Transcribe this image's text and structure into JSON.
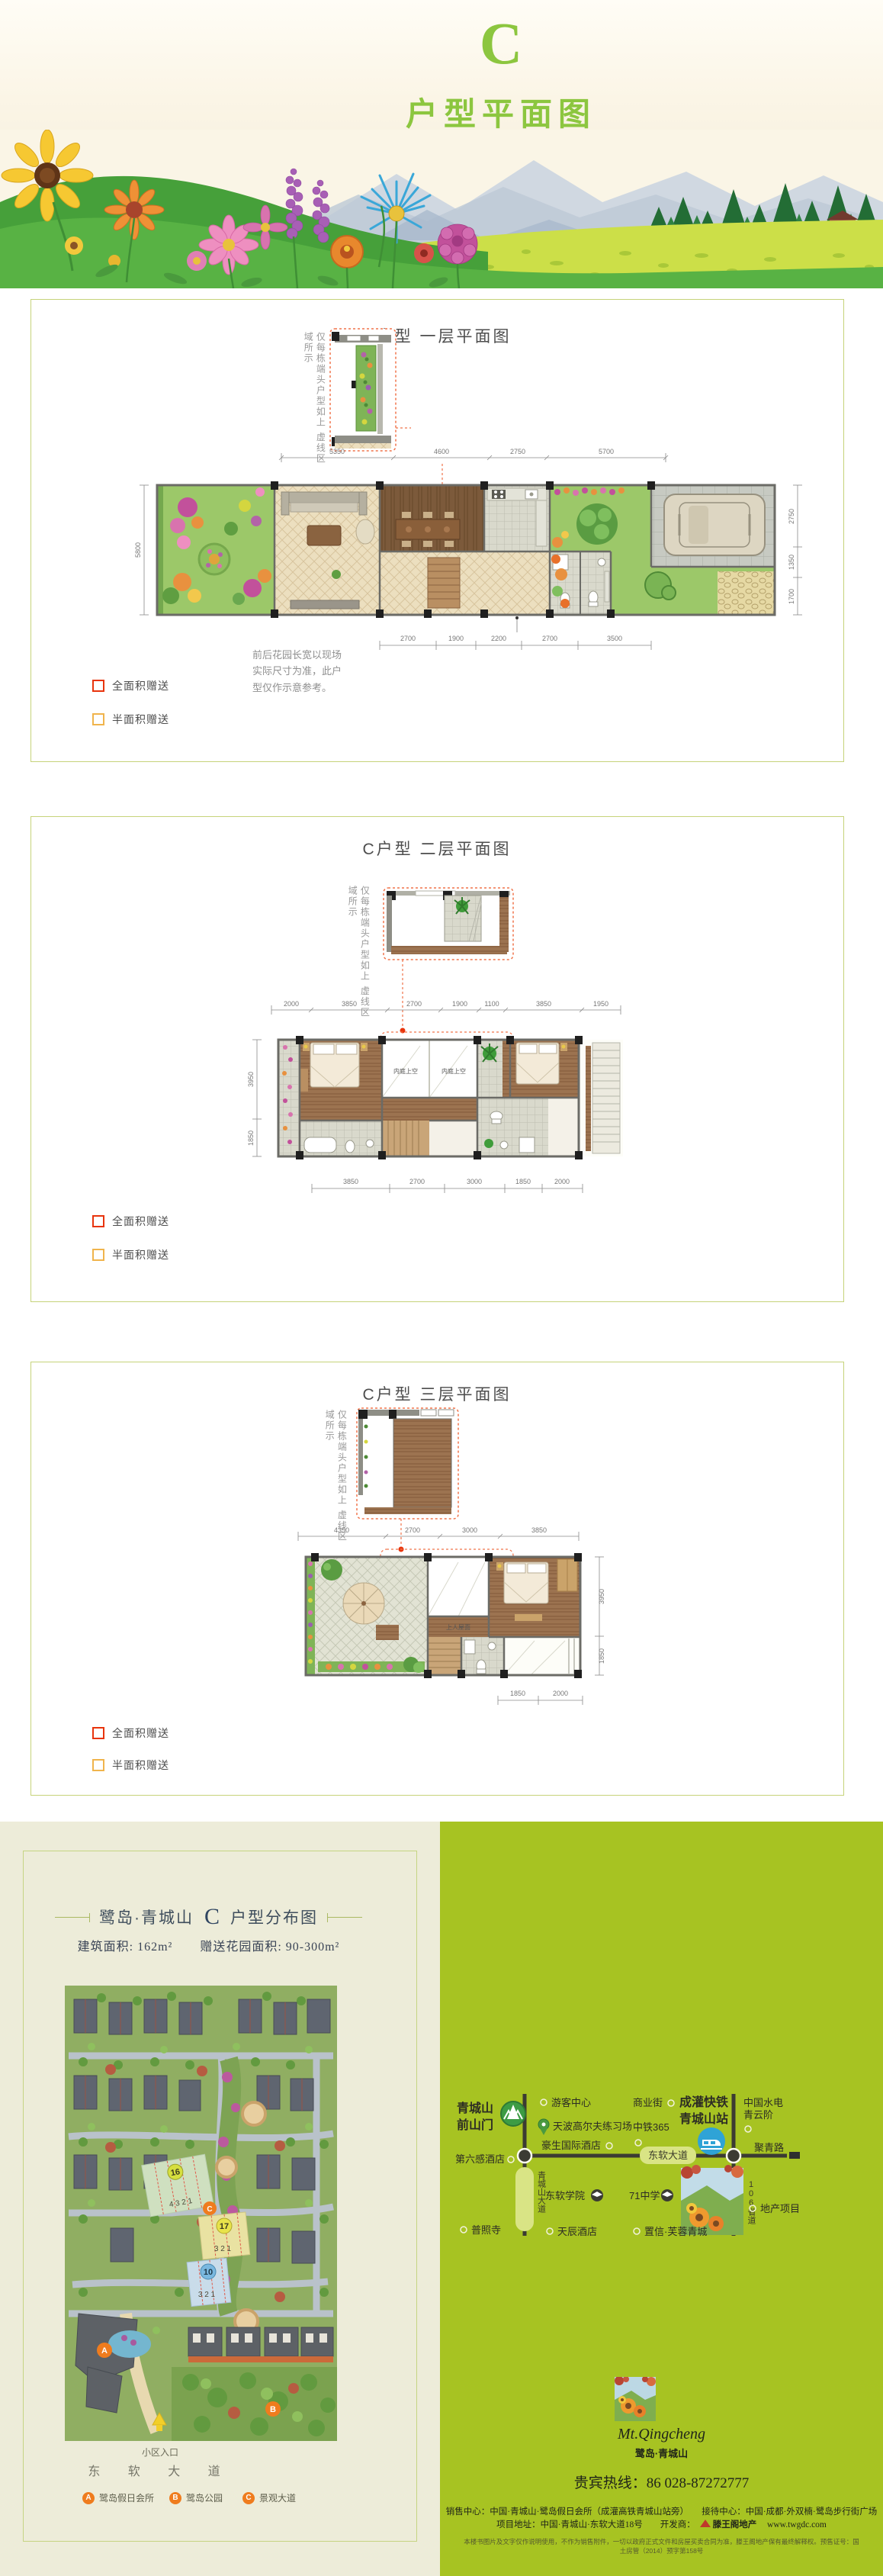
{
  "header": {
    "letter": "C",
    "title": "户型平面图"
  },
  "legend": {
    "full": "全面积赠送",
    "half": "半面积赠送"
  },
  "floor1": {
    "title": "C户型 一层平面图",
    "side_note_a": "仅每栋端头户型如上",
    "side_note_b": "虚线区域所示",
    "dims_top": [
      "5350",
      "4600",
      "2750",
      "5700"
    ],
    "dim_left": "5800",
    "dims_right": [
      "2750",
      "1350",
      "1700"
    ],
    "dims_bottom": [
      "2700",
      "1900",
      "2200",
      "2700",
      "3500"
    ],
    "note": "前后花园长宽以现场实际尺寸为准，此户型仅作示意参考。"
  },
  "floor2": {
    "title": "C户型 二层平面图",
    "side_note_a": "仅每栋端头户型如上",
    "side_note_b": "虚线区域所示",
    "dims_top": [
      "2000",
      "3850",
      "2700",
      "1900",
      "1100",
      "3850",
      "1950"
    ],
    "dims_left": [
      "3950",
      "1850"
    ],
    "dims_bottom": [
      "3850",
      "2700",
      "3000",
      "1850",
      "2000"
    ],
    "void_label_1": "内庭上空",
    "void_label_2": "内庭上空"
  },
  "floor3": {
    "title": "C户型 三层平面图",
    "side_note_a": "仅每栋端头户型如上",
    "side_note_b": "虚线区域所示",
    "dims_top": [
      "4350",
      "2700",
      "3000",
      "3850"
    ],
    "dims_right": [
      "3950",
      "1850"
    ],
    "dims_bottom": [
      "1850",
      "2000"
    ],
    "roof_label": "上人屋面"
  },
  "distribution": {
    "brand": "鹭岛·青城山",
    "letter": "C",
    "suffix": "户型分布图",
    "area_label_1": "建筑面积:",
    "area_value_1": "162m²",
    "area_label_2": "赠送花园面积:",
    "area_value_2": "90-300m²",
    "block16": "16",
    "block16_units": "4  3  2  1",
    "block17": "17",
    "block17_units": "3  2  1",
    "block10": "10",
    "block10_units": "3  2  1",
    "marker_a": "A",
    "marker_b": "B",
    "marker_c": "C",
    "entrance": "小区入口",
    "road": "东 软 大 道",
    "legend": [
      {
        "badge": "A",
        "label": "鹭岛假日会所"
      },
      {
        "badge": "B",
        "label": "鹭岛公园"
      },
      {
        "badge": "C",
        "label": "景观大道"
      }
    ]
  },
  "transit": {
    "gate1": "青城山",
    "gate2": "前山门",
    "hotel6": "第六感酒店",
    "visitor": "游客中心",
    "golf": "天波高尔夫练习场",
    "howard": "豪生国际酒店",
    "road_v1": "青城山大道",
    "road_h": "东软大道",
    "biz": "商业街",
    "zt365": "中铁365",
    "rail1": "成灌快铁",
    "rail2": "青城山站",
    "hydro1": "中国水电",
    "hydro2": "青云阶",
    "road_r": "聚青路",
    "road_v2": "106省道",
    "college": "东软学院",
    "school": "71中学",
    "estate": "地产项目",
    "temple": "普照寺",
    "tianchen": "天辰酒店",
    "zhixin": "置信·芙蓉青城"
  },
  "footer": {
    "logo_script": "Mt.Qingcheng",
    "logo_cn": "鹭岛·青城山",
    "hotline": "贵宾热线：86 028-87272777",
    "line1": "销售中心：中国·青城山·鹭岛假日会所（成灌高铁青城山站旁）　　接待中心：中国·成都·外双楠·鹭岛步行街广场",
    "line2_pre": "项目地址：中国·青城山·东软大道18号　　开发商：",
    "dev": "滕王阁地产",
    "url": "www.twgdc.com",
    "fine": "本楼书图片及文字仅作说明使用，不作为销售附件，一切以政府正式文件和房屋买卖合同为准，滕王阁地产保有最终解释权。预售证号：国土房管（2014）预字第158号"
  }
}
